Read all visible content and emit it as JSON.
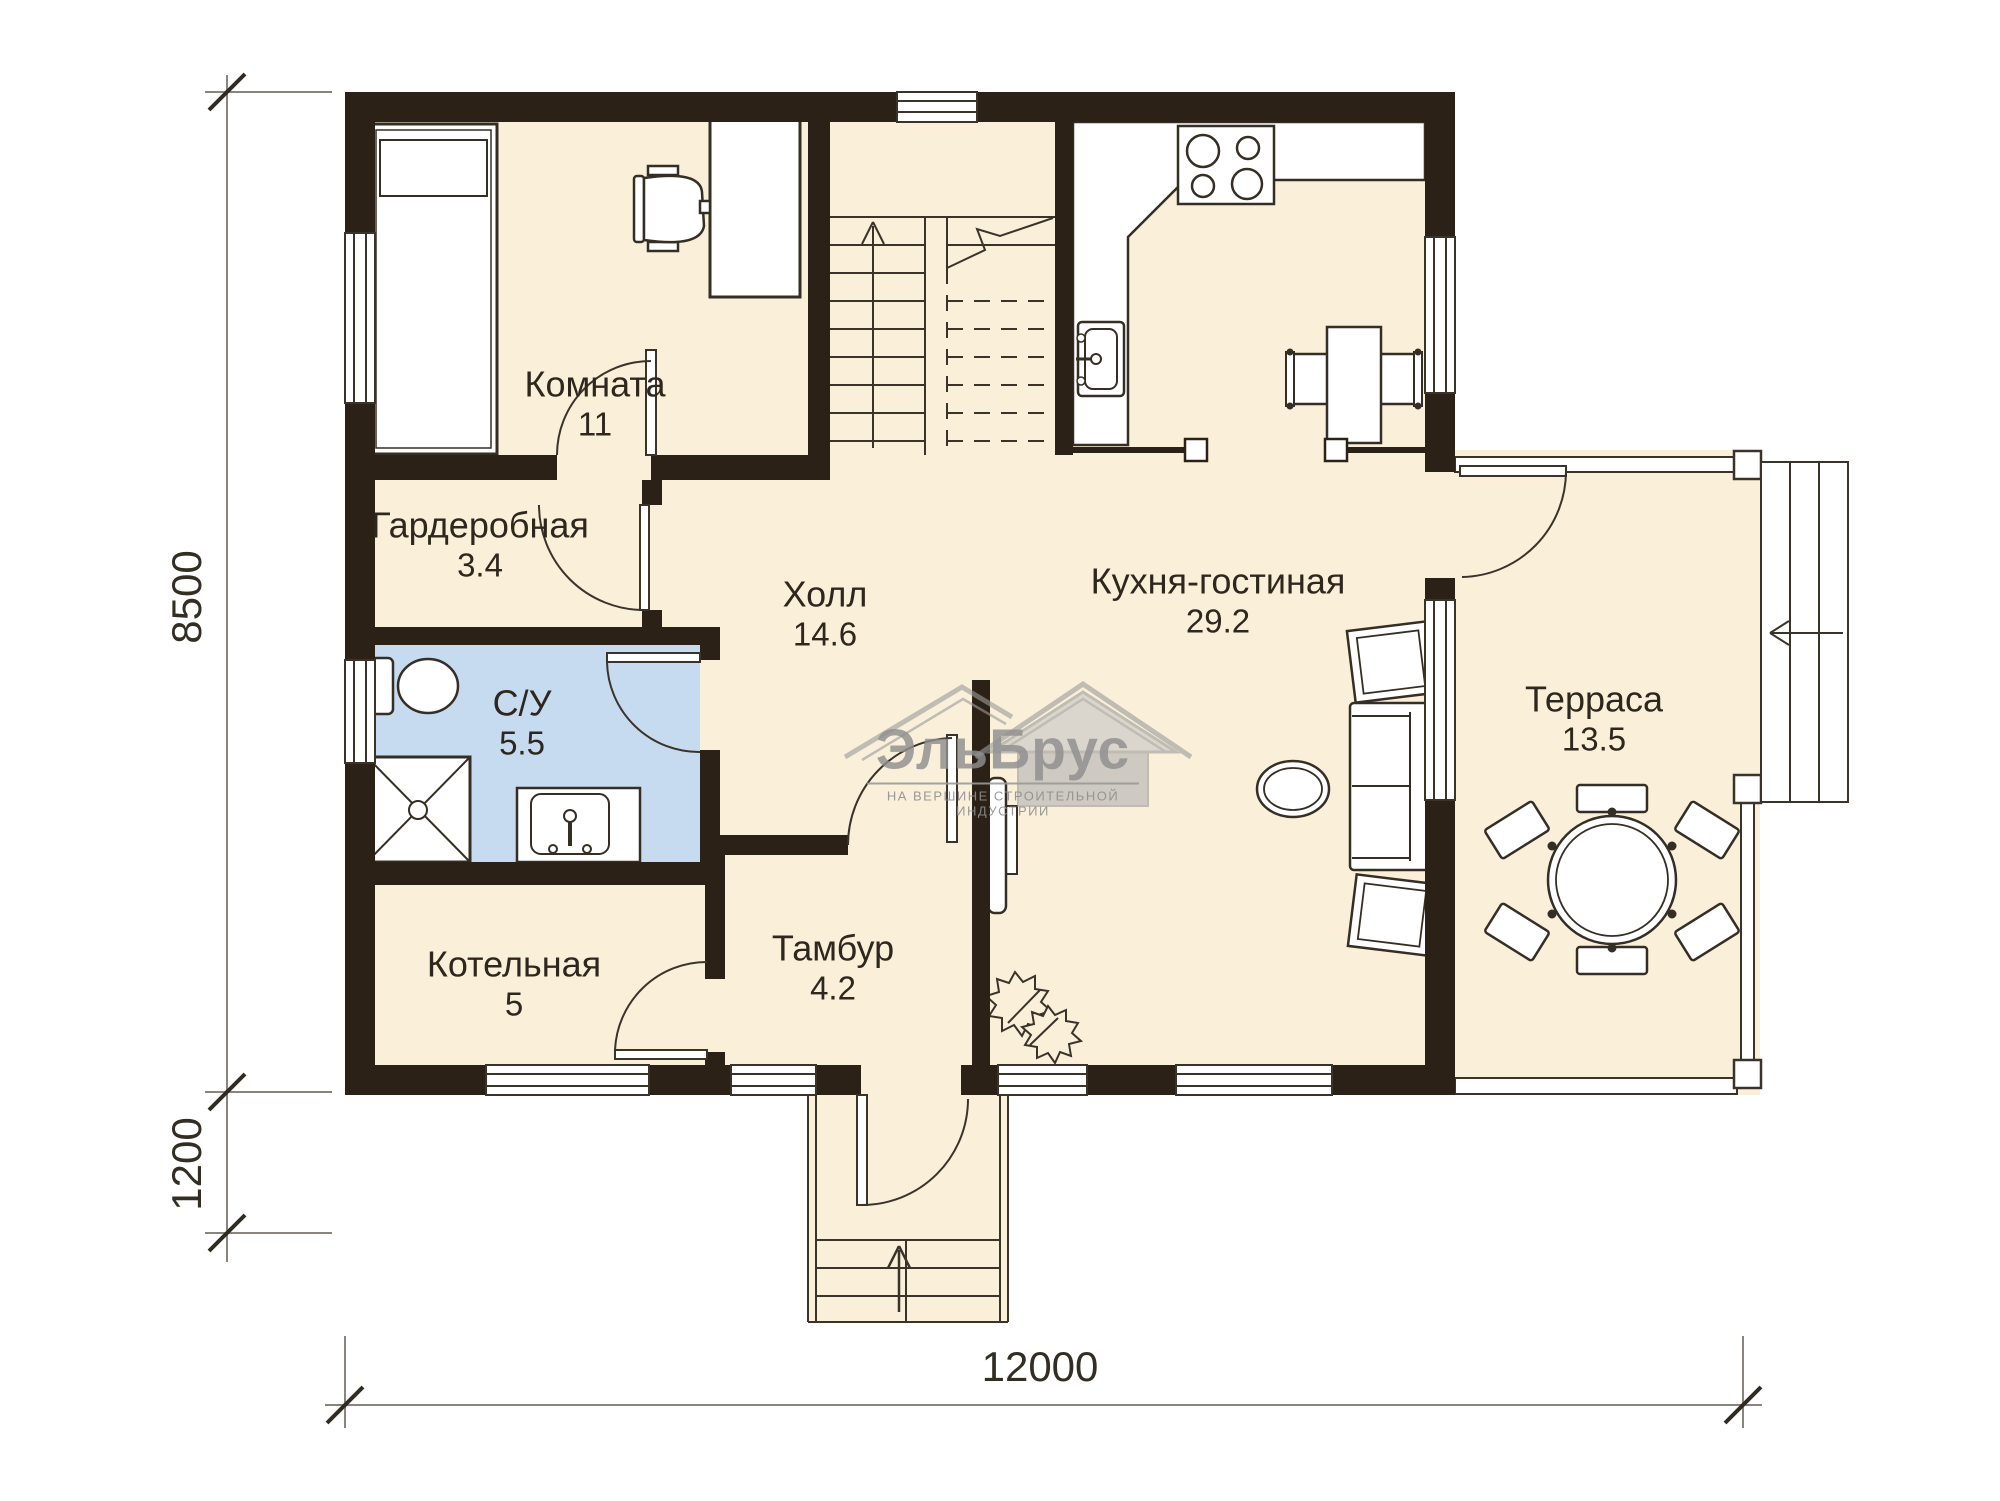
{
  "plan": {
    "title": "План первого этажа",
    "watermark": {
      "brand": "ЭльБрус",
      "tagline": "НА ВЕРШИНЕ СТРОИТЕЛЬНОЙ ИНДУСТРИИ"
    },
    "rooms": [
      {
        "id": "komnata",
        "name": "Комната",
        "area": "11"
      },
      {
        "id": "garderobnaya",
        "name": "Гардеробная",
        "area": "3.4"
      },
      {
        "id": "su",
        "name": "С/У",
        "area": "5.5"
      },
      {
        "id": "kotelnaya",
        "name": "Котельная",
        "area": "5"
      },
      {
        "id": "holl",
        "name": "Холл",
        "area": "14.6"
      },
      {
        "id": "tambur",
        "name": "Тамбур",
        "area": "4.2"
      },
      {
        "id": "kuhnya",
        "name": "Кухня-гостиная",
        "area": "29.2"
      },
      {
        "id": "terrasa",
        "name": "Терраса",
        "area": "13.5"
      }
    ],
    "dimensions": {
      "height_main": "8500",
      "height_porch": "1200",
      "width_total": "12000"
    },
    "colors": {
      "wall": "#2b2116",
      "floor": "#faf0da",
      "bathroom_floor": "#c7dbf0",
      "line": "#3a332a",
      "dimension": "#8a857c",
      "watermark": "#8f8f8f"
    }
  }
}
